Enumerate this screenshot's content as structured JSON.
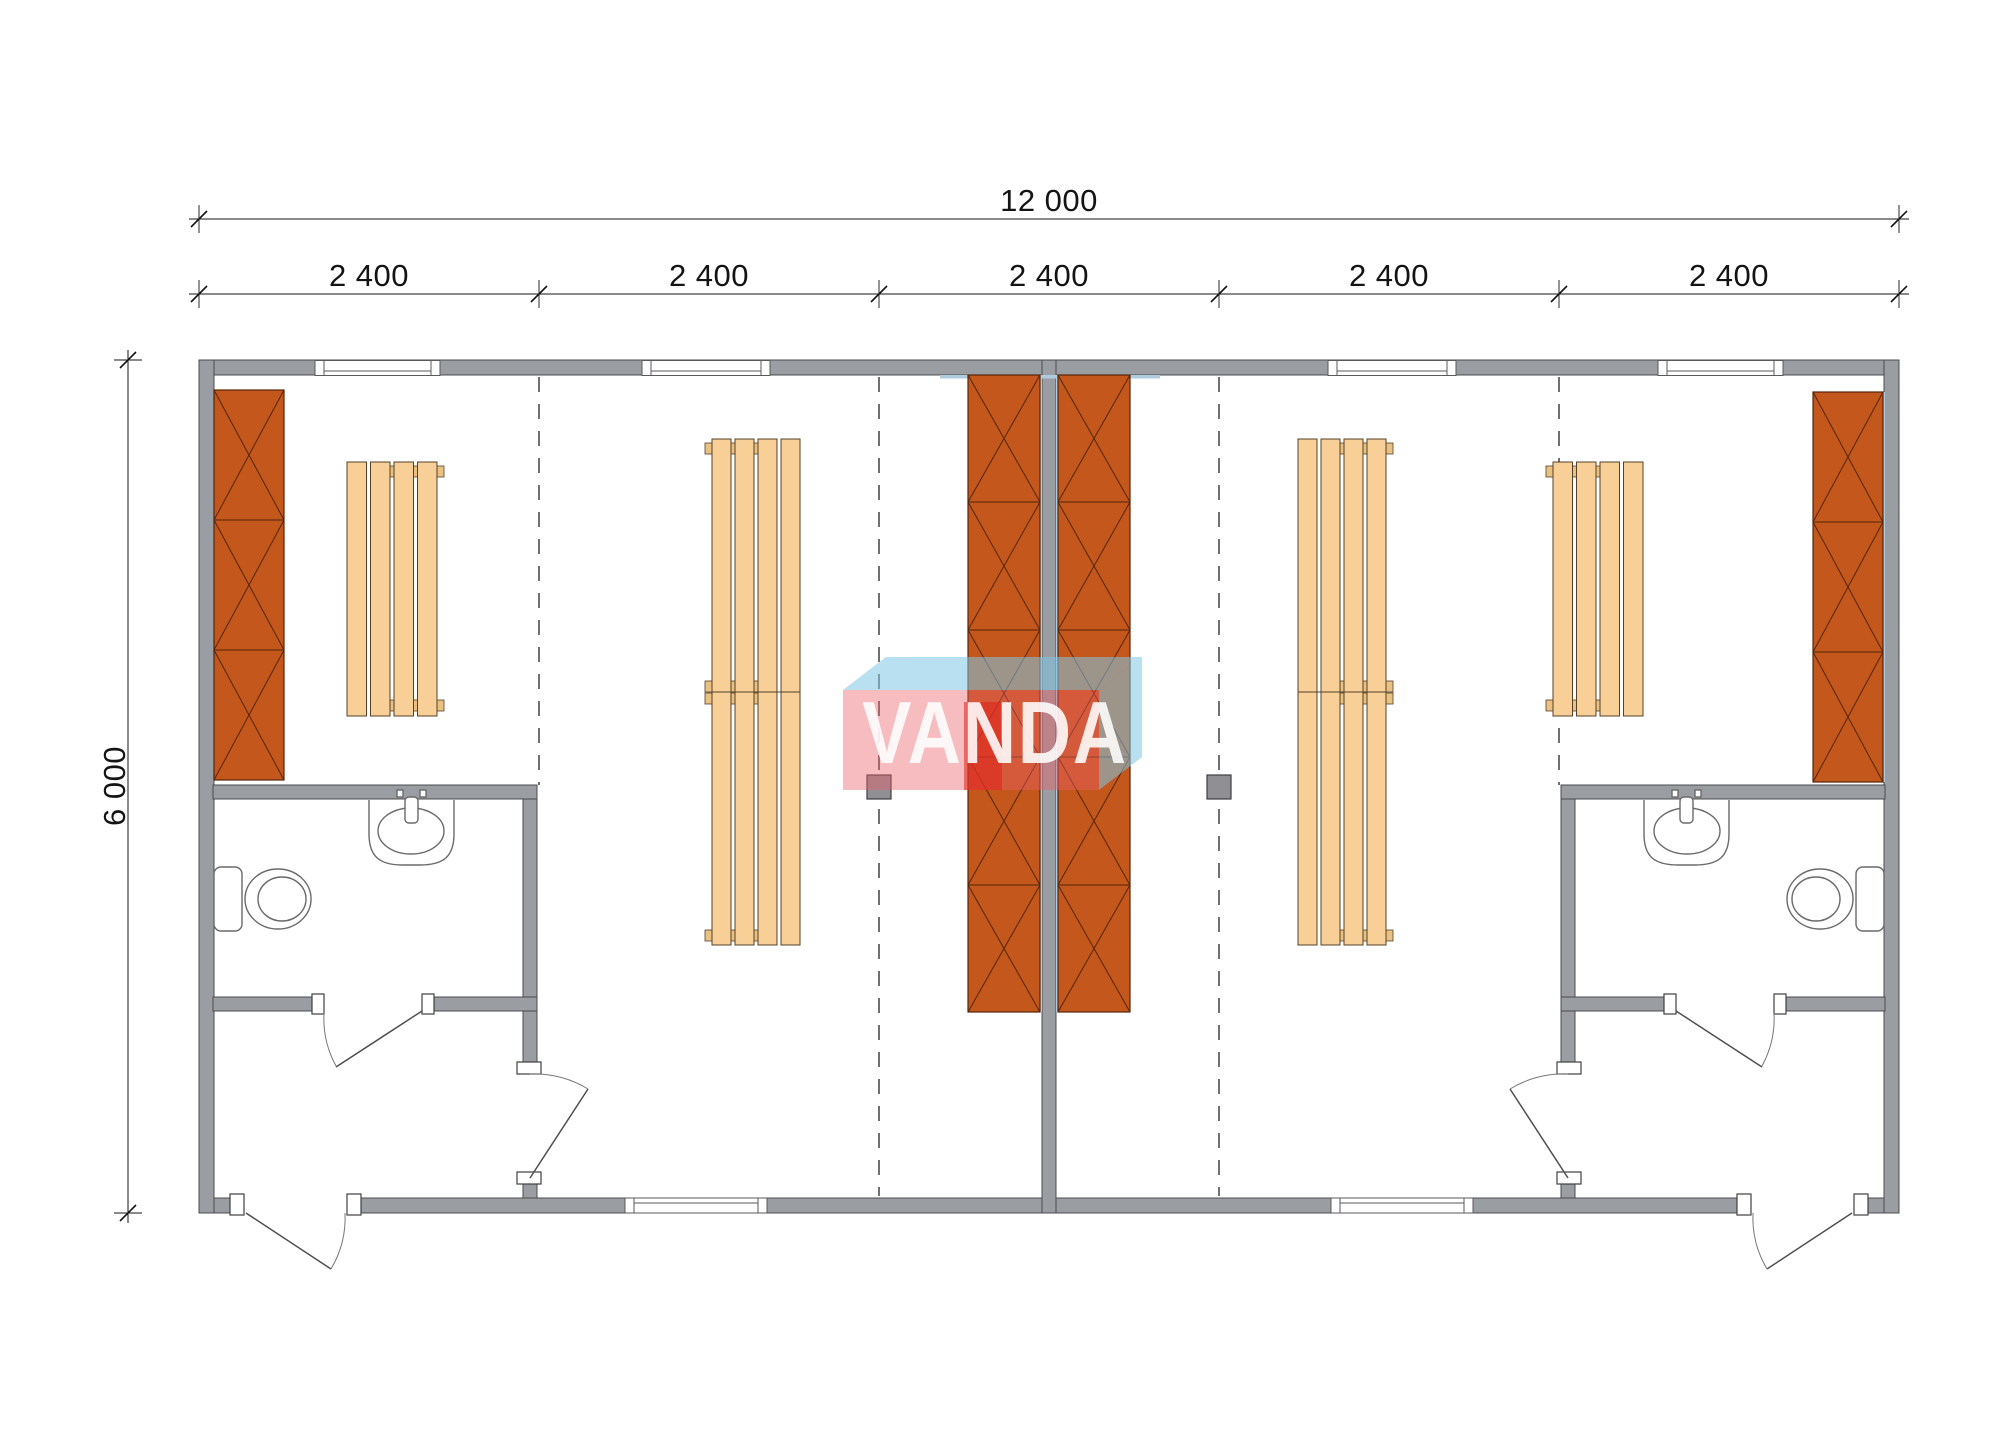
{
  "dimensions": {
    "overall_width_label": "12 000",
    "overall_height_label": "6 000",
    "module_labels": [
      "2 400",
      "2 400",
      "2 400",
      "2 400",
      "2 400"
    ]
  },
  "watermark": {
    "text": "VANDA"
  },
  "colors": {
    "bg": "#ffffff",
    "wall": "#9a9da1",
    "wall_stroke": "#4c4c4e",
    "dash": "#333333",
    "dim": "#141414",
    "locker": "#c4571c",
    "locker_edge": "#55250a",
    "bench": "#f7cf97",
    "bench_stroke": "#55412a",
    "bench_tab": "#e9c183",
    "insulation": "#afcbe0",
    "column": "#909094",
    "fixture": "#6a6a6a",
    "wm_pink": "rgba(235,95,105,0.42)",
    "wm_red": "rgba(226,32,24,0.55)",
    "wm_blue": "rgba(125,198,230,0.55)",
    "wm_text": "rgba(255,255,255,0.88)"
  }
}
